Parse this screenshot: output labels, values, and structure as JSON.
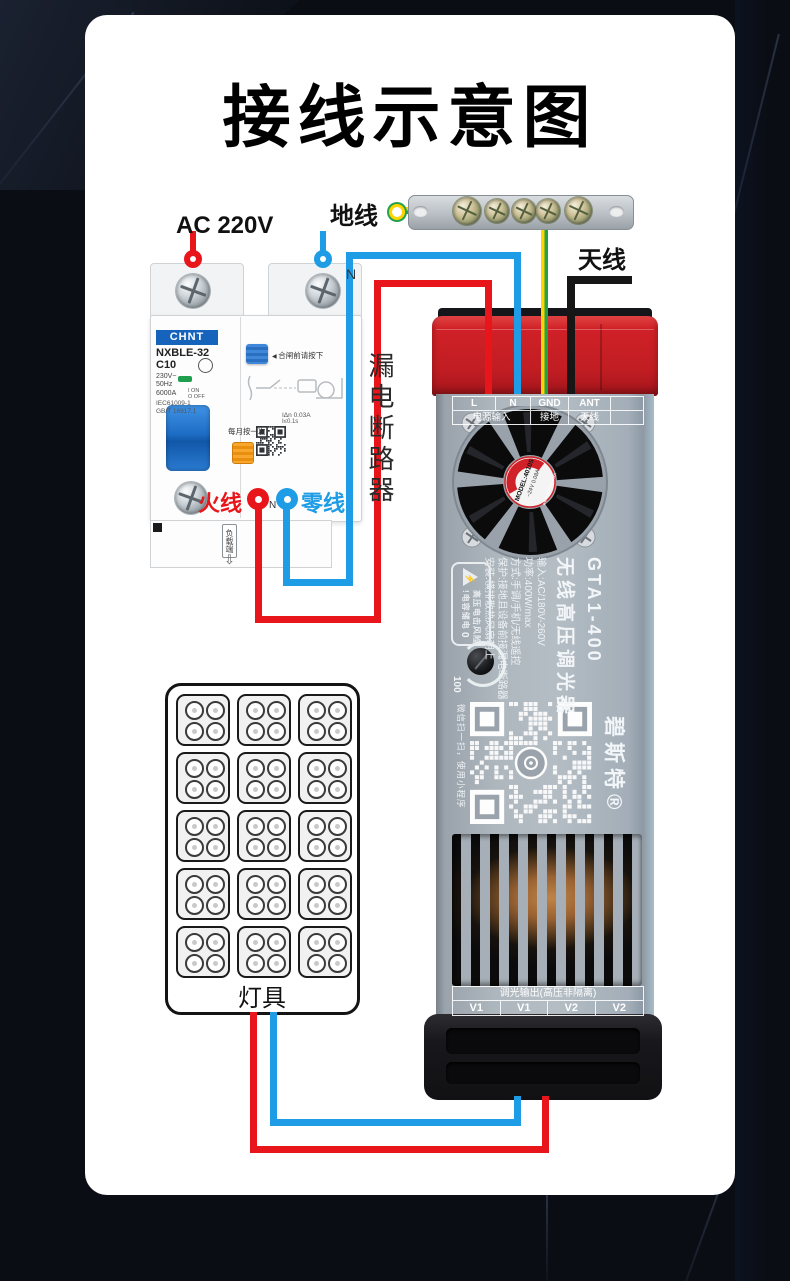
{
  "title": "接线示意图",
  "top": {
    "ground_label": "地线",
    "antenna_label": "天线"
  },
  "breaker": {
    "input_label": "AC 220V",
    "n_top": "N",
    "brand": "CHNT",
    "model": "NXBLE-32",
    "rating": "C10",
    "voltage": "230V~",
    "frequency": "50Hz",
    "breaking_capacity": "6000A",
    "on_label": "I ON",
    "off_label": "O OFF",
    "standard1": "IEC61009-1",
    "standard2": "GB/T 16917.1",
    "press_note": "合闸前请按下",
    "leakage_current": "IΔn 0.03A",
    "trip_time": "I≤0.1s",
    "monthly_note": "每月按一次",
    "side_label": "漏电断路器",
    "live_label": "火线",
    "neutral_label": "零线",
    "n_bottom": "N",
    "load_label": "负载端"
  },
  "device": {
    "model": "GTA1-400",
    "product_name": "无线高压调光器",
    "specs": [
      "输入:AC/180V-260V",
      "功率:400W/max",
      "方式:手调/手机/无线遥控",
      "保护:接地且设备前接漏电断路器",
      "安装:横排散热风扇朝上"
    ],
    "warning_line1": "高压电击风险",
    "warning_line2": "!电容储电",
    "knob_min": "0",
    "knob_max": "100",
    "fan_model": "MODEL:4010S",
    "fan_rating": "~24V 0.08A",
    "fan_site": "www.ahfbdz.com",
    "qr_caption": "微信扫一扫，使用小程序",
    "brand": "碧斯特®",
    "input_header": [
      "L",
      "N",
      "GND",
      "ANT"
    ],
    "input_sub": [
      "电源输入",
      "接地",
      "天线"
    ],
    "output_title": "调光输出(高压非隔离)",
    "output_terminals": [
      "V1",
      "V1",
      "V2",
      "V2"
    ]
  },
  "lamp": {
    "label": "灯具"
  },
  "colors": {
    "wire_red": "#e8151a",
    "wire_blue": "#1f9ce6",
    "wire_yellow": "#ffd400",
    "wire_green": "#23a24d",
    "wire_black": "#161616",
    "cap_red": "#c62127",
    "body_gray": "#a8b1b9",
    "card_white": "#ffffff",
    "background_dark": "#0a0d14"
  }
}
